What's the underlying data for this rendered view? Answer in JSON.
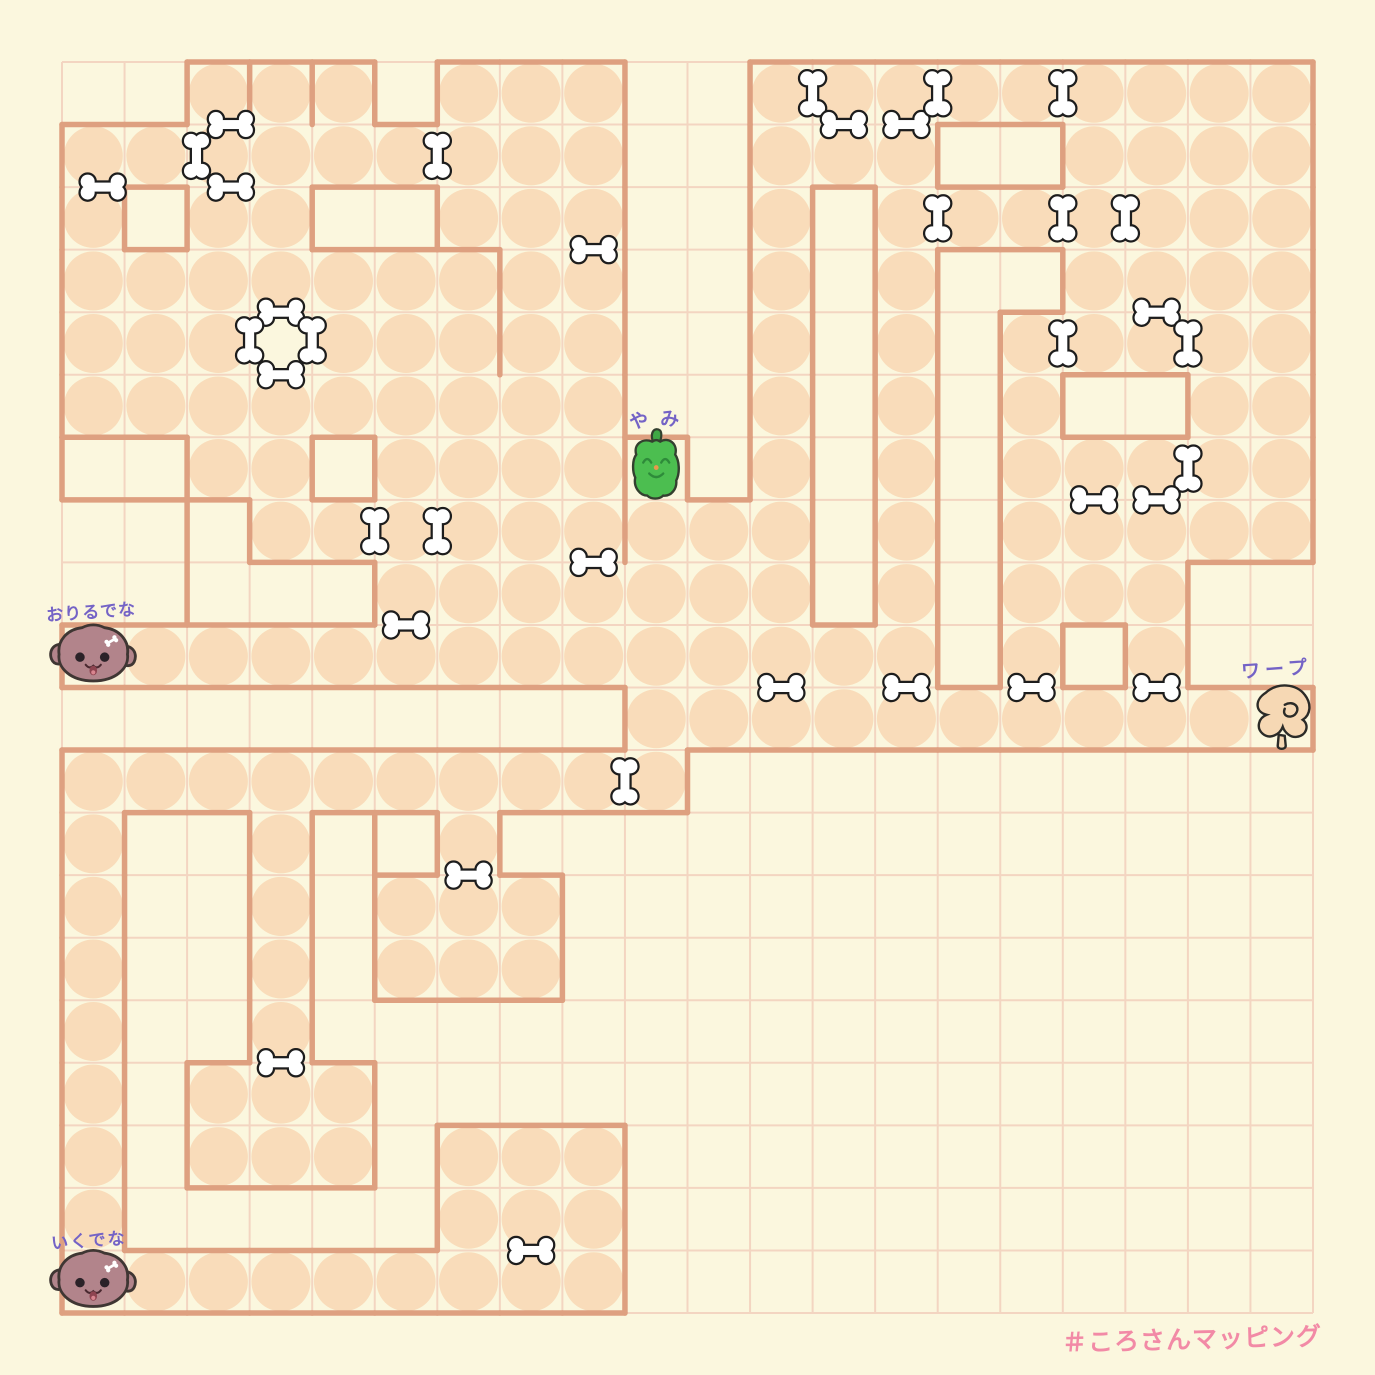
{
  "canvas": {
    "width": 1375,
    "height": 1375,
    "background": "#FBF7DE"
  },
  "grid": {
    "origin_x": 62,
    "origin_y": 62,
    "cell": 62.55,
    "cols": 20,
    "rows": 20,
    "line_color": "#F3D5C1",
    "line_width": 2
  },
  "map": {
    "circle_color": "#F9DCBA",
    "wall_color": "#DEA080",
    "wall_width": 5.5,
    "bone_fill": "#FFFFFF",
    "bone_outline": "#1D1D1D",
    "rows": [
      "00111011100111111111",
      "11111111100111001111",
      "10110011100101111111",
      "11111111100101001111",
      "11101111100101011111",
      "11111111100101010011",
      "00110111100101011111",
      "00011111111101011111",
      "00000111111101011100",
      "01111111111111010100",
      "00000000011111111110",
      "11111111110000000000",
      "10010010000000000000",
      "10010111000000000000",
      "10010111000000000000",
      "10010000000000000000",
      "10111000000000000000",
      "10111011100000000000",
      "10000011100000000000",
      "01111111100000000000"
    ],
    "rooms": [
      [
        3,
        4
      ]
    ],
    "extra_walls": [
      [
        7,
        3,
        7,
        5
      ],
      [
        6,
        3,
        7,
        3
      ],
      [
        9,
        6,
        9,
        8
      ],
      [
        2,
        7,
        2,
        9
      ],
      [
        0,
        7,
        2,
        7
      ],
      [
        0,
        6,
        0,
        7
      ],
      [
        5,
        12,
        5,
        13
      ],
      [
        3,
        0,
        3,
        1
      ],
      [
        4,
        0,
        4,
        1
      ]
    ]
  },
  "bones": [
    {
      "x": 0.65,
      "y": 2,
      "dir": "h"
    },
    {
      "x": 2.15,
      "y": 1.5,
      "dir": "v"
    },
    {
      "x": 2.7,
      "y": 1,
      "dir": "h"
    },
    {
      "x": 2.7,
      "y": 2,
      "dir": "h"
    },
    {
      "x": 6,
      "y": 1.5,
      "dir": "v"
    },
    {
      "x": 3.5,
      "y": 4,
      "dir": "h"
    },
    {
      "x": 3,
      "y": 4.45,
      "dir": "v"
    },
    {
      "x": 4,
      "y": 4.45,
      "dir": "v"
    },
    {
      "x": 3.5,
      "y": 5,
      "dir": "h"
    },
    {
      "x": 8.5,
      "y": 3,
      "dir": "h"
    },
    {
      "x": 12,
      "y": 0.5,
      "dir": "v"
    },
    {
      "x": 12.5,
      "y": 1,
      "dir": "h"
    },
    {
      "x": 13.5,
      "y": 1,
      "dir": "h"
    },
    {
      "x": 14,
      "y": 0.5,
      "dir": "v"
    },
    {
      "x": 16,
      "y": 0.5,
      "dir": "v"
    },
    {
      "x": 14,
      "y": 2.5,
      "dir": "v"
    },
    {
      "x": 16,
      "y": 2.5,
      "dir": "v"
    },
    {
      "x": 17,
      "y": 2.5,
      "dir": "v"
    },
    {
      "x": 17.5,
      "y": 4,
      "dir": "h"
    },
    {
      "x": 16,
      "y": 4.5,
      "dir": "v"
    },
    {
      "x": 18,
      "y": 4.5,
      "dir": "v"
    },
    {
      "x": 18,
      "y": 6.5,
      "dir": "v"
    },
    {
      "x": 16.5,
      "y": 7,
      "dir": "h"
    },
    {
      "x": 17.5,
      "y": 7,
      "dir": "h"
    },
    {
      "x": 5,
      "y": 7.5,
      "dir": "v"
    },
    {
      "x": 6,
      "y": 7.5,
      "dir": "v"
    },
    {
      "x": 8.5,
      "y": 8,
      "dir": "h"
    },
    {
      "x": 5.5,
      "y": 9,
      "dir": "h"
    },
    {
      "x": 11.5,
      "y": 10,
      "dir": "h"
    },
    {
      "x": 13.5,
      "y": 10,
      "dir": "h"
    },
    {
      "x": 15.5,
      "y": 10,
      "dir": "h"
    },
    {
      "x": 17.5,
      "y": 10,
      "dir": "h"
    },
    {
      "x": 9,
      "y": 11.5,
      "dir": "v"
    },
    {
      "x": 6.5,
      "y": 13,
      "dir": "h"
    },
    {
      "x": 3.5,
      "y": 16,
      "dir": "h"
    },
    {
      "x": 7.5,
      "y": 19,
      "dir": "h"
    }
  ],
  "characters": {
    "pepper": {
      "label": "やみ",
      "col": 9,
      "row": 6,
      "body_color": "#4CBE50",
      "face_color": "#2E8B3A",
      "nose_color": "#E89A4C",
      "label_color": "#7463C6"
    },
    "dog_mid": {
      "label": "おりるでな",
      "col": 0,
      "row": 9,
      "body_color": "#B2848B",
      "label_color": "#7463C6"
    },
    "dog_bottom": {
      "label": "いくでな",
      "col": 0,
      "row": 19,
      "body_color": "#B2848B",
      "label_color": "#7463C6"
    },
    "warp": {
      "label": "ワープ",
      "col": 19,
      "row": 10,
      "body_color": "#F6D8B4",
      "label_color": "#7463C6"
    }
  },
  "labels_px": {
    "pepper": {
      "x": 630,
      "y": 407,
      "size": 19,
      "spacing": 12
    },
    "dog_mid": {
      "x": 47,
      "y": 601,
      "size": 17,
      "spacing": 1
    },
    "warp": {
      "x": 1242,
      "y": 657,
      "size": 19,
      "spacing": 5
    },
    "dog_bottom": {
      "x": 52,
      "y": 1229,
      "size": 17,
      "spacing": 2
    }
  },
  "signature": {
    "text": "＃ころさんマッピング",
    "color": "#F28AA6",
    "x": 1062,
    "y": 1320,
    "size": 25,
    "spacing": 1
  }
}
